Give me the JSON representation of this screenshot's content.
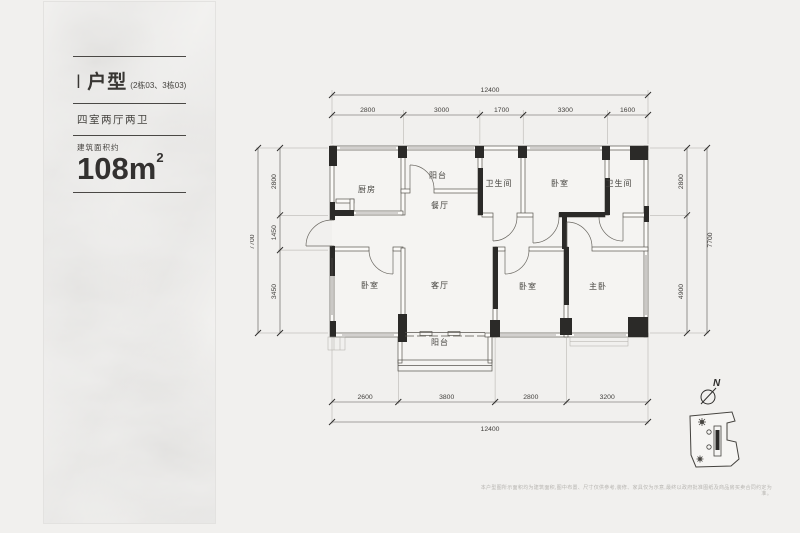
{
  "info_panel": {
    "type_code": "I",
    "type_name": "户型",
    "type_sub": "(2栋03、3栋03)",
    "rooms_summary": "四室两厅两卫",
    "area_label": "建筑面积约",
    "area_number": "108",
    "area_unit": "m",
    "area_exponent": "2"
  },
  "plan": {
    "room_labels": {
      "kitchen": "厨房",
      "balcony_top": "阳台",
      "dining": "餐厅",
      "bath_left": "卫生间",
      "bedroom_top": "卧室",
      "bath_right": "卫生间",
      "bedroom_left": "卧室",
      "living": "客厅",
      "bedroom_mid": "卧室",
      "master": "主卧",
      "balcony_bottom": "阳台"
    },
    "dimensions": {
      "top_total": "12400",
      "top_segments": [
        "2800",
        "3000",
        "1700",
        "3300",
        "1600"
      ],
      "left_total": "7700",
      "left_segments": [
        "2800",
        "1450",
        "3450"
      ],
      "right_total": "7700",
      "right_segments": [
        "2800",
        "4900"
      ],
      "bottom_total": "12400",
      "bottom_segments": [
        "2600",
        "3800",
        "2800",
        "3200"
      ]
    }
  },
  "compass": {
    "north_label": "N"
  },
  "footer": {
    "disclaimer": "本户型图所示面积均为建筑面积,图中布置、尺寸仅供参考,装修、家具仅为示意,最终以政府批准图纸及商品房买卖合同约定为准。"
  },
  "colors": {
    "wall_black": "#2b2a28",
    "line": "#57544f",
    "background": "#f1f0ee",
    "text": "#3e3c39"
  }
}
